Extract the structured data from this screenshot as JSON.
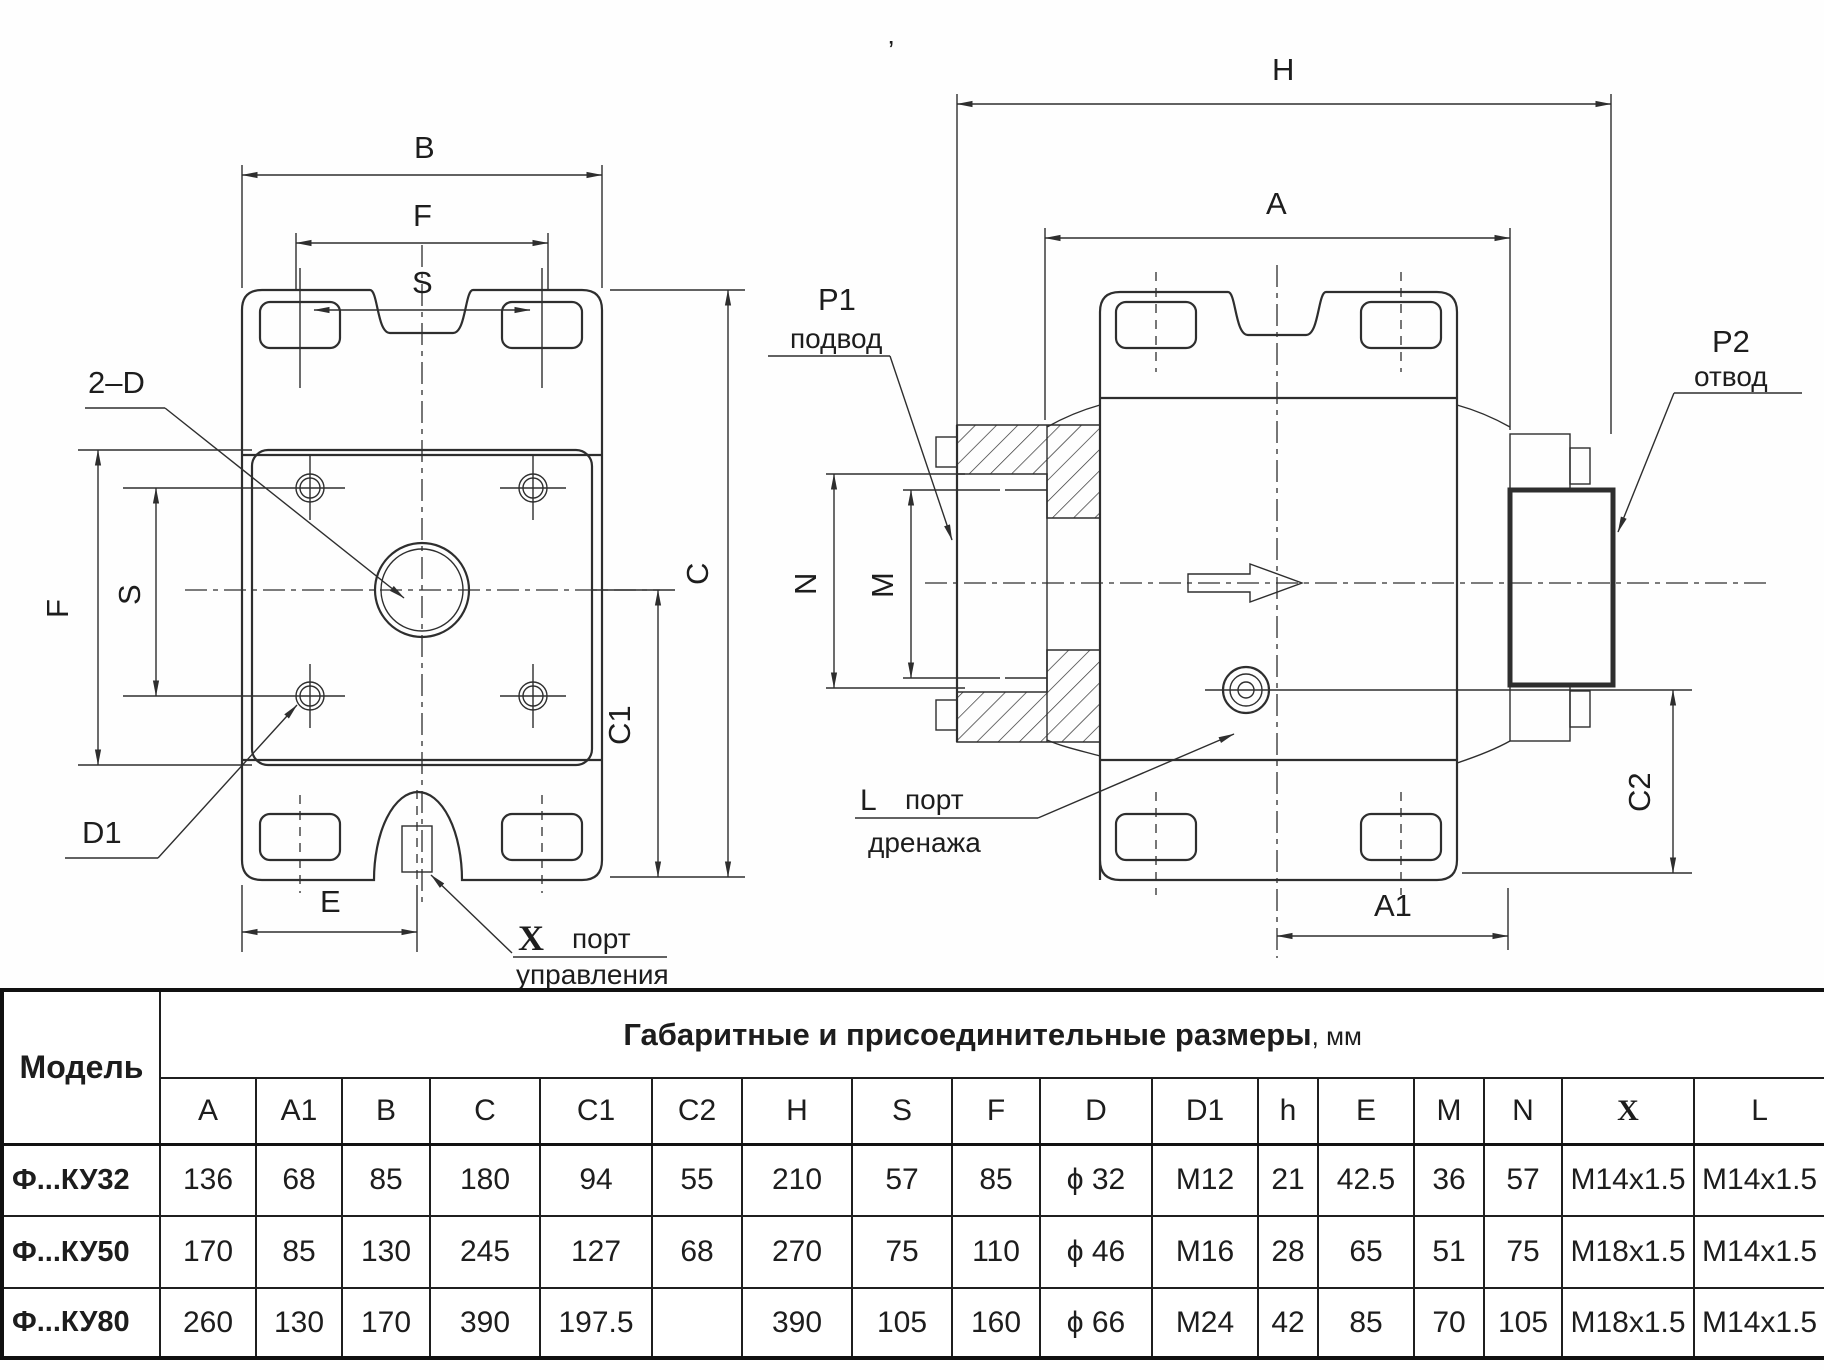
{
  "drawing": {
    "left_view": {
      "dim_b": "B",
      "dim_f_top": "F",
      "dim_s_top": "S",
      "dim_f_side": "F",
      "dim_s_side": "S",
      "dim_c": "C",
      "dim_c1": "C1",
      "dim_e": "E",
      "callout_2d": "2–D",
      "callout_d1": "D1",
      "x_port": {
        "symbol": "X",
        "word1": "порт",
        "word2": "управления"
      }
    },
    "right_view": {
      "dim_h": "H",
      "dim_a": "A",
      "dim_a1": "A1",
      "dim_c2": "C2",
      "dim_n": "N",
      "dim_m": "M",
      "p1": {
        "name": "P1",
        "desc": "подвод"
      },
      "p2": {
        "name": "P2",
        "desc": "отвод"
      },
      "l_port": {
        "symbol": "L",
        "word1": "порт",
        "word2": "дренажа"
      },
      "tick_mark": "’"
    }
  },
  "table": {
    "model_header": "Модель",
    "title": "Габаритные и присоединительные размеры",
    "title_unit": ", мм",
    "columns": [
      "A",
      "A1",
      "B",
      "C",
      "C1",
      "C2",
      "H",
      "S",
      "F",
      "D",
      "D1",
      "h",
      "E",
      "M",
      "N",
      "X",
      "L"
    ],
    "rows": [
      {
        "model": "Ф...КУ32",
        "values": [
          "136",
          "68",
          "85",
          "180",
          "94",
          "55",
          "210",
          "57",
          "85",
          "ϕ 32",
          "M12",
          "21",
          "42.5",
          "36",
          "57",
          "M14x1.5",
          "M14x1.5"
        ]
      },
      {
        "model": "Ф...КУ50",
        "values": [
          "170",
          "85",
          "130",
          "245",
          "127",
          "68",
          "270",
          "75",
          "110",
          "ϕ 46",
          "M16",
          "28",
          "65",
          "51",
          "75",
          "M18x1.5",
          "M14x1.5"
        ]
      },
      {
        "model": "Ф...КУ80",
        "values": [
          "260",
          "130",
          "170",
          "390",
          "197.5",
          "",
          "390",
          "105",
          "160",
          "ϕ 66",
          "M24",
          "42",
          "85",
          "70",
          "105",
          "M18x1.5",
          "M14x1.5"
        ]
      }
    ]
  }
}
